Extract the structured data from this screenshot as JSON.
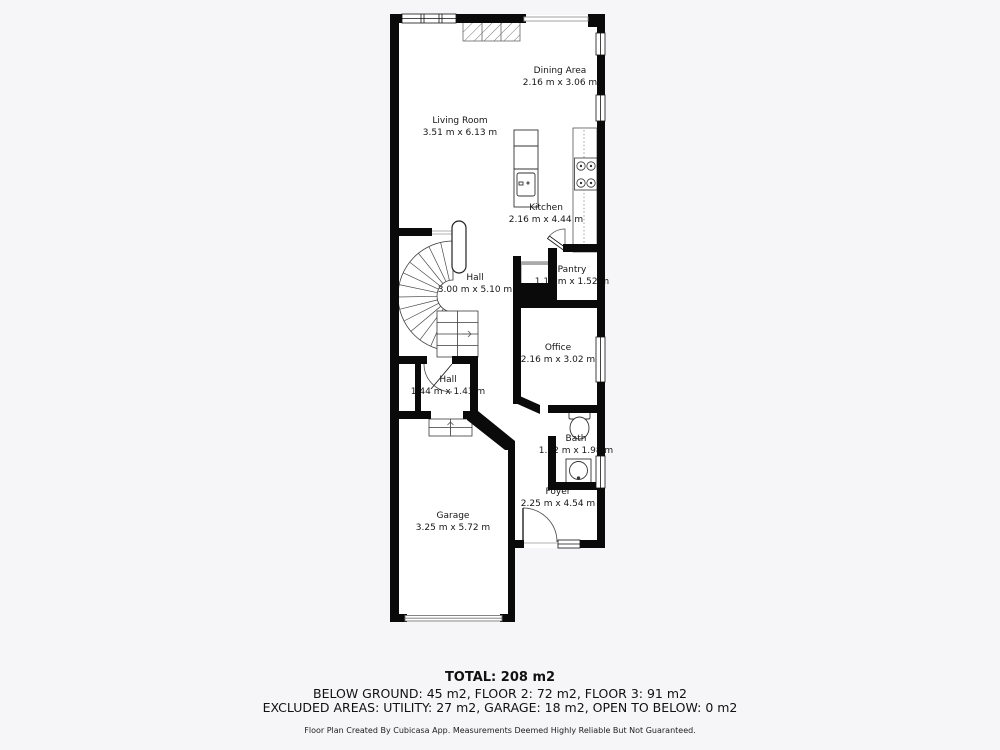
{
  "colors": {
    "background": "#f6f6f8",
    "floor": "#ffffff",
    "wall": "#0a0a0a",
    "fixture_line": "#3a3a3a",
    "text": "#161616"
  },
  "rooms": [
    {
      "name": "Dining Area",
      "dims": "2.16 m x 3.06 m"
    },
    {
      "name": "Living Room",
      "dims": "3.51 m x 6.13 m"
    },
    {
      "name": "Kitchen",
      "dims": "2.16 m x 4.44 m"
    },
    {
      "name": "Hall",
      "dims": "3.00 m x 5.10 m"
    },
    {
      "name": "Pantry",
      "dims": "1.16 m x 1.52 m"
    },
    {
      "name": "Office",
      "dims": "2.16 m x 3.02 m"
    },
    {
      "name": "Hall",
      "dims": "1.44 m x 1.43 m"
    },
    {
      "name": "Bath",
      "dims": "1.02 m x 1.98 m"
    },
    {
      "name": "Foyer",
      "dims": "2.25 m x 4.54 m"
    },
    {
      "name": "Garage",
      "dims": "3.25 m x 5.72 m"
    }
  ],
  "summary": {
    "total": "TOTAL: 208 m2",
    "floors": "BELOW GROUND: 45 m2, FLOOR 2: 72 m2, FLOOR 3: 91 m2",
    "excluded": "EXCLUDED AREAS: UTILITY: 27 m2, GARAGE: 18 m2, OPEN TO BELOW: 0 m2",
    "disclaimer": "Floor Plan Created By Cubicasa App. Measurements Deemed Highly Reliable But Not Guaranteed."
  }
}
